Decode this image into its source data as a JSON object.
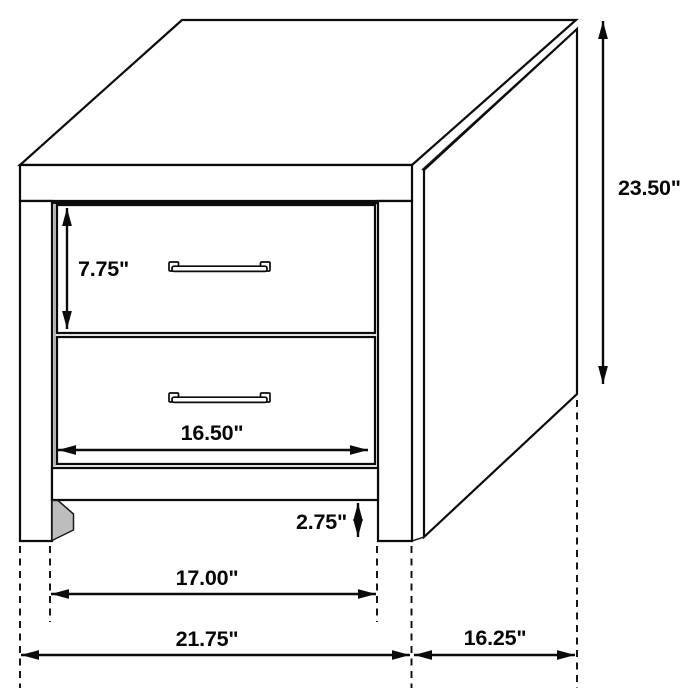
{
  "diagram": {
    "subject": "2-drawer nightstand dimension line drawing",
    "background_color": "#ffffff",
    "line_color": "#0b0b0b",
    "units": "inches",
    "dimensions": {
      "overall_height": "23.50\"",
      "drawer_front_height": "7.75\"",
      "drawer_front_width": "16.50\"",
      "leg_clearance_height": "2.75\"",
      "inner_leg_span": "17.00\"",
      "overall_width": "21.75\"",
      "overall_depth": "16.25\""
    }
  }
}
